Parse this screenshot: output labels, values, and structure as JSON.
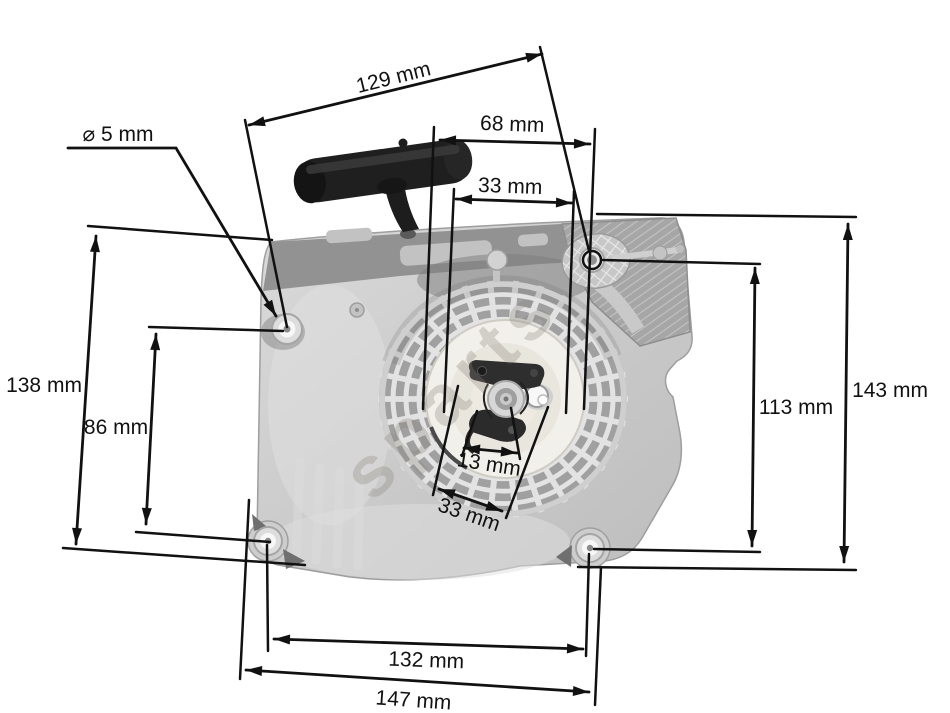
{
  "diagram": {
    "watermark": "sparts",
    "dims": {
      "d129": "129 mm",
      "d68": "68 mm",
      "d33_top": "33 mm",
      "dia5": "⌀ 5 mm",
      "d138": "138 mm",
      "d86": "86 mm",
      "d13": "13 mm",
      "d33_bottom": "33 mm",
      "d113": "113 mm",
      "d143": "143 mm",
      "d132": "132 mm",
      "d147": "147 mm"
    },
    "colors": {
      "annotation": "#111111",
      "housing": "#cccccc",
      "pulley": "#f2f0ea",
      "handle": "#1f1f1f",
      "background": "#ffffff"
    }
  }
}
